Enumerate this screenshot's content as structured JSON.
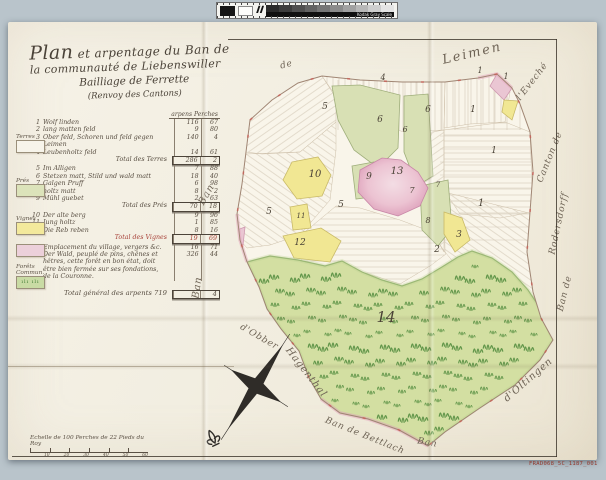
{
  "calibration": {
    "label": "Kodak Gray Scale",
    "patches": [
      "#2b2b2b",
      "#3d3d3d",
      "#4f4f4f",
      "#626262",
      "#767676",
      "#8b8b8b",
      "#a1a1a1",
      "#b7b7b7",
      "#cecece",
      "#e4e4e4"
    ]
  },
  "title": {
    "word1": "Plan",
    "line1": "et arpentage du Ban de",
    "line2": "la communauté de Liebenswiller",
    "line3": "Bailliage de Ferrette",
    "line4": "(Renvoy des Cantons)"
  },
  "table": {
    "header": "arpens  Perches",
    "rows": [
      {
        "n": "1",
        "label": "Wolf linden",
        "v1": "116",
        "v2": "67",
        "kind": "item"
      },
      {
        "n": "2",
        "label": "lang matten feld",
        "v1": "9",
        "v2": "80",
        "kind": "item"
      },
      {
        "n": "3",
        "label": "Ober feld, Schoren und feld gegen Leimen",
        "v1": "140",
        "v2": "4",
        "kind": "item"
      },
      {
        "n": "4",
        "label": "Leubenholtz feld",
        "v1": "14",
        "v2": "61",
        "kind": "item"
      },
      {
        "n": "",
        "label": "Total des Terres",
        "v1": "286",
        "v2": "2",
        "kind": "total"
      },
      {
        "n": "5",
        "label": "Im Alligen",
        "v1": "7",
        "v2": "88",
        "kind": "item"
      },
      {
        "n": "6",
        "label": "Stetzen matt, Stild und wald matt",
        "v1": "18",
        "v2": "40",
        "kind": "item"
      },
      {
        "n": "7",
        "label": "Galgen Pruff",
        "v1": "6",
        "v2": "98",
        "kind": "item"
      },
      {
        "n": "8",
        "label": "holtz matt",
        "v1": "8",
        "v2": "2",
        "kind": "item"
      },
      {
        "n": "9",
        "label": "Mühl guebet",
        "v1": "2",
        "v2": "63",
        "kind": "item"
      },
      {
        "n": "",
        "label": "Total des Prés",
        "v1": "70",
        "v2": "18",
        "kind": "total"
      },
      {
        "n": "10",
        "label": "Der alte berg",
        "v1": "9",
        "v2": "96",
        "kind": "item"
      },
      {
        "n": "11",
        "label": "Jung holtz",
        "v1": "1",
        "v2": "85",
        "kind": "item"
      },
      {
        "n": "12",
        "label": "Die Reb reben",
        "v1": "8",
        "v2": "16",
        "kind": "item"
      },
      {
        "n": "",
        "label": "Total des Vignes",
        "v1": "19",
        "v2": "69",
        "kind": "total",
        "accent": true
      },
      {
        "n": "13",
        "label": "Emplacement du village, vergers &c.",
        "v1": "16",
        "v2": "71",
        "kind": "item"
      },
      {
        "n": "14",
        "label": "Der Wald, peuplé de pins, chênes et\nhêtres, cette forêt en bon état, doit\nêtre bien fermée sur ses fondations,\nde la Couronne.",
        "v1": "326",
        "v2": "44",
        "kind": "item"
      },
      {
        "n": "",
        "label": "Total général des arpents 719",
        "v1": "",
        "v2": "4",
        "kind": "grand"
      }
    ]
  },
  "swatches": [
    {
      "label": "Terres",
      "color": "#f7f4ea",
      "top": 134,
      "trees": false
    },
    {
      "label": "Prés",
      "color": "#dce3ba",
      "top": 178,
      "trees": false
    },
    {
      "label": "Vignes",
      "color": "#f3e99c",
      "top": 216,
      "trees": false
    },
    {
      "label": "",
      "color": "#ecd0da",
      "top": 244,
      "trees": false
    },
    {
      "label": "Forêts\nCommun.",
      "color": "#c9dba4",
      "top": 264,
      "trees": true
    }
  ],
  "scale": {
    "caption": "Echelle de 100 Perches de 22 Pieds du Roy",
    "ticks": [
      "10",
      "20",
      "30",
      "40",
      "50",
      "60"
    ]
  },
  "map": {
    "boundary_labels": [
      {
        "text": "de",
        "x": 287,
        "y": 67,
        "rot": -15,
        "size": 9
      },
      {
        "text": "Leimen",
        "x": 473,
        "y": 57,
        "rot": -13,
        "size": 13,
        "ls": 2
      },
      {
        "text": "l'Eveché",
        "x": 534,
        "y": 83,
        "rot": -52,
        "size": 9
      },
      {
        "text": "Canton de",
        "x": 552,
        "y": 158,
        "rot": -68,
        "size": 9
      },
      {
        "text": "Rodersdorff",
        "x": 561,
        "y": 224,
        "rot": -78,
        "size": 9
      },
      {
        "text": "Ban de",
        "x": 567,
        "y": 294,
        "rot": -76,
        "size": 9
      },
      {
        "text": "Ban",
        "x": 209,
        "y": 196,
        "rot": -60,
        "size": 10
      },
      {
        "text": "Ban",
        "x": 200,
        "y": 288,
        "rot": -82,
        "size": 10
      },
      {
        "text": "d'Obber",
        "x": 258,
        "y": 339,
        "rot": 30,
        "size": 9
      },
      {
        "text": "Hagenthal",
        "x": 304,
        "y": 374,
        "rot": 52,
        "size": 10
      },
      {
        "text": "Ban de Bettlach",
        "x": 364,
        "y": 438,
        "rot": 22,
        "size": 9
      },
      {
        "text": "Ban",
        "x": 427,
        "y": 445,
        "rot": 10,
        "size": 9
      },
      {
        "text": "d'Oltingen",
        "x": 530,
        "y": 382,
        "rot": -41,
        "size": 10
      }
    ],
    "parcel_numbers": [
      {
        "t": "1",
        "x": 480,
        "y": 73,
        "s": 8
      },
      {
        "t": "1",
        "x": 506,
        "y": 79,
        "s": 8
      },
      {
        "t": "1",
        "x": 473,
        "y": 112,
        "s": 9
      },
      {
        "t": "1",
        "x": 494,
        "y": 153,
        "s": 9
      },
      {
        "t": "1",
        "x": 481,
        "y": 206,
        "s": 10
      },
      {
        "t": "2",
        "x": 437,
        "y": 252,
        "s": 9
      },
      {
        "t": "3",
        "x": 459,
        "y": 237,
        "s": 9
      },
      {
        "t": "4",
        "x": 383,
        "y": 80,
        "s": 8
      },
      {
        "t": "5",
        "x": 325,
        "y": 109,
        "s": 9
      },
      {
        "t": "5",
        "x": 269,
        "y": 214,
        "s": 9
      },
      {
        "t": "5",
        "x": 341,
        "y": 207,
        "s": 9
      },
      {
        "t": "6",
        "x": 380,
        "y": 122,
        "s": 9
      },
      {
        "t": "6",
        "x": 405,
        "y": 132,
        "s": 8
      },
      {
        "t": "6",
        "x": 428,
        "y": 112,
        "s": 9
      },
      {
        "t": "7",
        "x": 412,
        "y": 193,
        "s": 8
      },
      {
        "t": "7",
        "x": 438,
        "y": 187,
        "s": 7
      },
      {
        "t": "8",
        "x": 428,
        "y": 223,
        "s": 8
      },
      {
        "t": "9",
        "x": 369,
        "y": 179,
        "s": 9
      },
      {
        "t": "10",
        "x": 315,
        "y": 177,
        "s": 10
      },
      {
        "t": "11",
        "x": 301,
        "y": 218,
        "s": 7
      },
      {
        "t": "12",
        "x": 300,
        "y": 245,
        "s": 9
      },
      {
        "t": "13",
        "x": 397,
        "y": 174,
        "s": 10
      },
      {
        "t": "14",
        "x": 386,
        "y": 322,
        "s": 15
      }
    ]
  },
  "footer": {
    "code": "FRAD068_5C_1187_001"
  },
  "colors": {
    "background": "#b9c4cb",
    "paper": "#f3efe4",
    "ink": "#4c443a",
    "red_ink": "#a8433a",
    "meadow_green": "#d8e0b4",
    "forest_green": "#d3dfa2",
    "vine_yellow": "#f1e793",
    "village_pink": "#ecc3d2"
  }
}
